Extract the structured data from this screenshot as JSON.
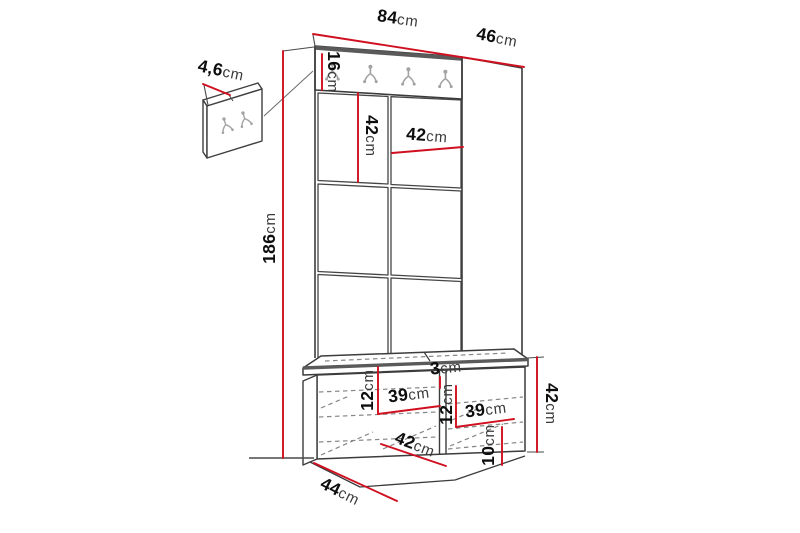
{
  "diagram_title": "hallway-unit-dimension-drawing",
  "colors": {
    "dimension_line": "#d01020",
    "drawing_line": "#3c3c3c",
    "hook": "#a3a3a3",
    "background": "#ffffff"
  },
  "dimensions": {
    "top_width": {
      "num": "84",
      "unit": "cm"
    },
    "top_depth": {
      "num": "46",
      "unit": "cm"
    },
    "mini_panel_depth": {
      "num": "4,6",
      "unit": "cm"
    },
    "rail_height": {
      "num": "16",
      "unit": "cm"
    },
    "left_panel_height": {
      "num": "42",
      "unit": "cm"
    },
    "right_panel_width": {
      "num": "42",
      "unit": "cm"
    },
    "total_height": {
      "num": "186",
      "unit": "cm"
    },
    "divider_thickness": {
      "num": "3",
      "unit": "cm"
    },
    "left_top_compartment_height": {
      "num": "12",
      "unit": "cm"
    },
    "left_compartment_width": {
      "num": "39",
      "unit": "cm"
    },
    "right_top_compartment_height": {
      "num": "12",
      "unit": "cm"
    },
    "right_compartment_width": {
      "num": "39",
      "unit": "cm"
    },
    "bench_inner_depth": {
      "num": "42",
      "unit": "cm"
    },
    "right_bottom_compartment_height": {
      "num": "10",
      "unit": "cm"
    },
    "bench_height": {
      "num": "42",
      "unit": "cm"
    },
    "bench_depth": {
      "num": "44",
      "unit": "cm"
    }
  }
}
